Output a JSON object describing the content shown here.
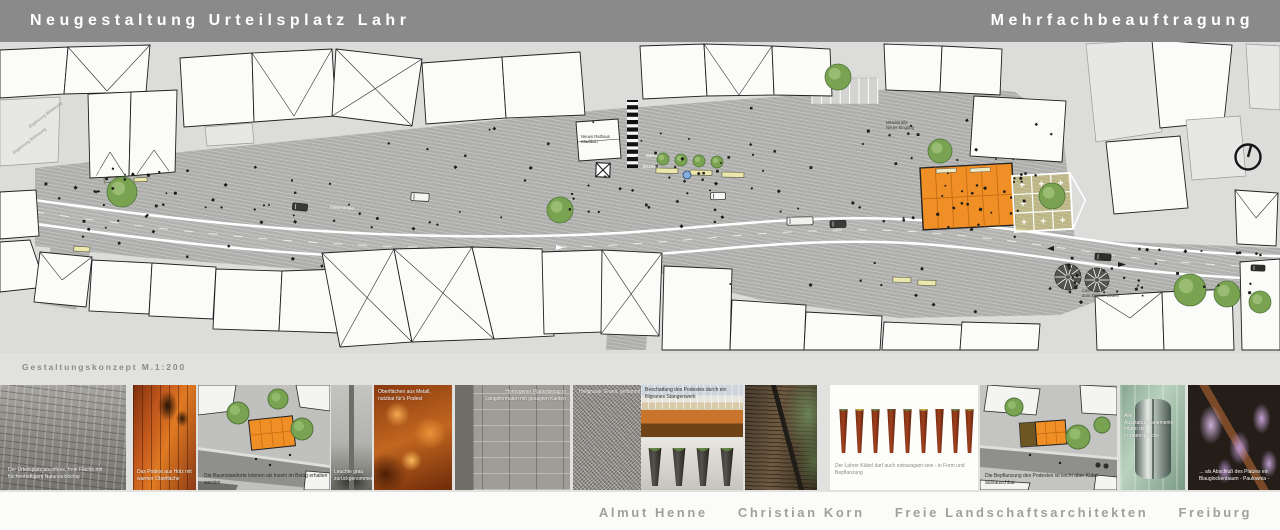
{
  "header": {
    "title_left": "Neugestaltung Urteilsplatz Lahr",
    "title_right": "Mehrfachbeauftragung",
    "bg_color": "#8a8a8a",
    "text_color": "#ffffff"
  },
  "plan": {
    "caption": "Gestaltungskonzept  M.1:200",
    "labels": {
      "linde_1": "Linde mit",
      "linde_2": "Bänken",
      "rathaus_1": "Neues Rathaus",
      "rathaus_2": "Stadtbau",
      "mittel_1": "Mittelstraße",
      "mittel_2": "Neuer Eingang",
      "cafe_1": "Cafe",
      "cafe_2": "Zum Kleinen Löwen",
      "baenke": "Bänke",
      "brunnen": "Brunnen",
      "erg_1": "Ergänzung Bebauung",
      "erg_2": "Ergänzung Bebauung",
      "strasse": "Kaiserstraße"
    },
    "colors": {
      "background": "#dcdcda",
      "street": "#aeaeac",
      "podium_orange": "#ef8f25",
      "tree_green": "#79a351"
    }
  },
  "gallery": {
    "items": [
      {
        "caption": "Der Urteilsplatz als offene, freie Fläche mit flächenhaftigem Natursteinbelag"
      },
      {
        "caption": "Das Podest aus Holz mit warmer Oberfläche"
      },
      {
        "caption": "Die Baumstandorte können als Inseln im Belag erhalten werden"
      },
      {
        "caption": "Leuchte grau zurückgenommen"
      },
      {
        "caption": "Oberflächen aus Metall, nutzbar für's Podest"
      },
      {
        "caption": "Homogener Plattenbelag in Längsformaten mit gesägten Kanten"
      },
      {
        "caption": "Hellgrauer Granit, geflammt"
      },
      {
        "caption": "Beschattung des Podestes durch ein filigranes Stangenwerk"
      },
      {
        "caption": ""
      },
      {
        "caption": "Der Lahrer Kübel darf auch extravagant sein - in Form und Bepflanzung"
      },
      {
        "caption": "Die Bepflanzung des Podestes ist leicht über Kübel austauschbar"
      },
      {
        "caption": "Alle Ausstattungselemente folgen der Formensprache"
      },
      {
        "caption": "... als Abschluß des Platzes ein Blauglockenbaum - Paulownia -"
      }
    ]
  },
  "footer": {
    "credits": [
      "Almut Henne",
      "Christian Korn",
      "Freie Landschaftsarchitekten",
      "Freiburg"
    ]
  }
}
